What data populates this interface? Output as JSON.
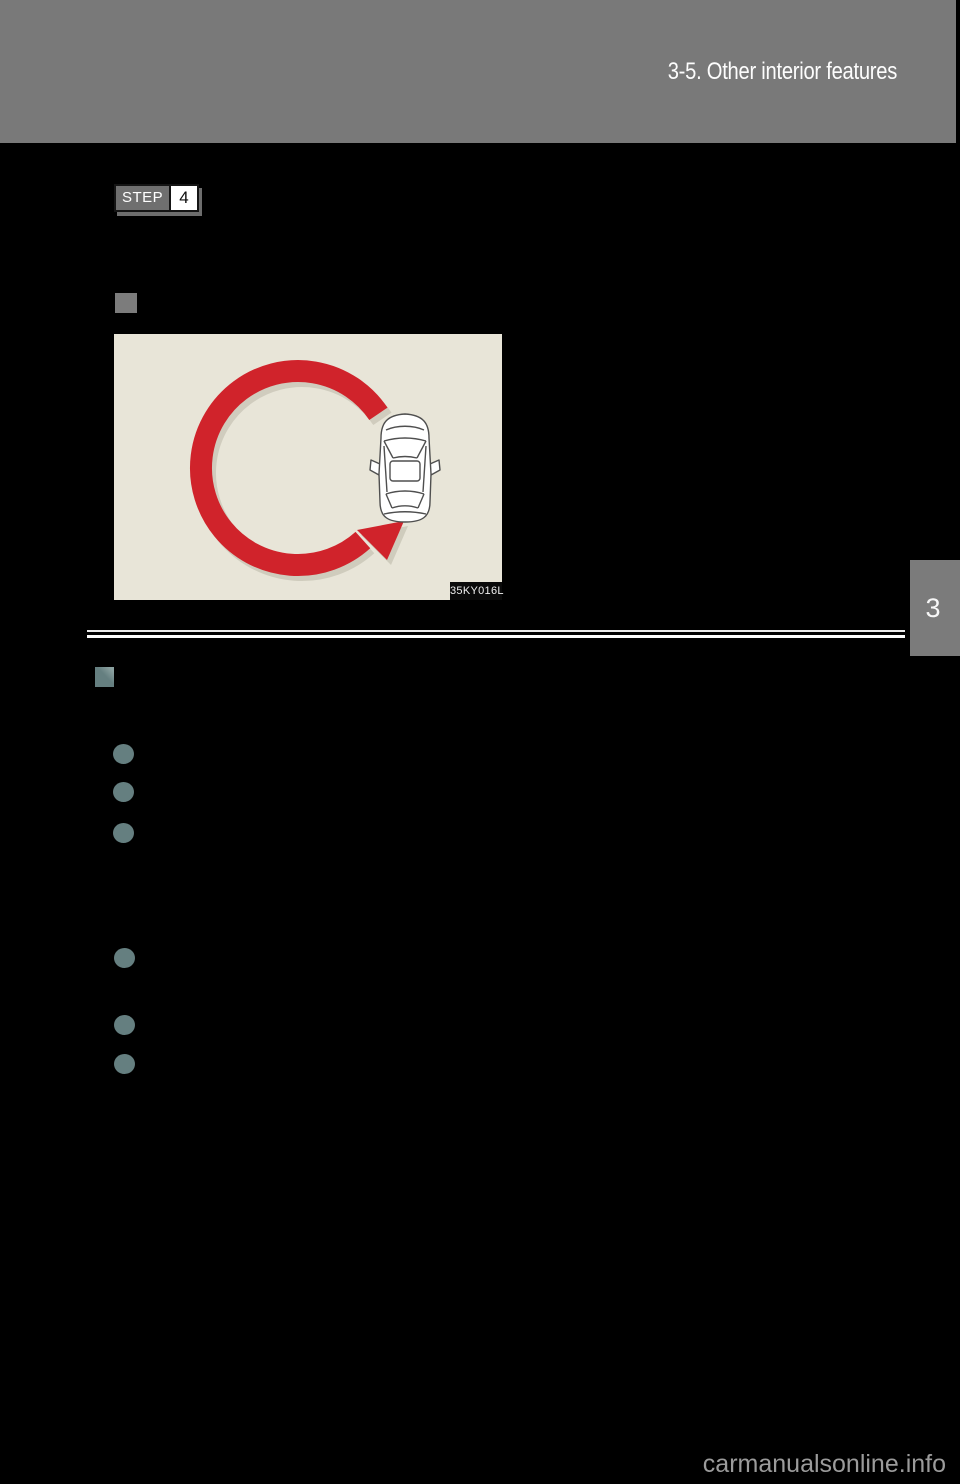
{
  "page_header": {
    "title": "3-5. Other interior features"
  },
  "step_marker": {
    "label": "STEP",
    "number": "4"
  },
  "figure": {
    "image_code": "35KY016L",
    "alt": "Top view of a car with a large red arrow showing driving in a counterclockwise circle"
  },
  "chapter_tab": {
    "number": "3"
  },
  "watermark": {
    "text": "carmanualsonline.info"
  },
  "list_markers": {
    "square_bullets": 2,
    "circle_bullets": 6
  },
  "colors": {
    "page_background": "#000000",
    "header_band": "#797979",
    "figure_background": "#e8e5d8",
    "arrow_red": "#d0232b",
    "arrow_shadow": "#b7b4a3",
    "bullet_teal": "#657f80",
    "marker_gray": "#7c7c7c",
    "divider_white": "#fcfcfc",
    "watermark_gray": "#9b9b9b"
  }
}
